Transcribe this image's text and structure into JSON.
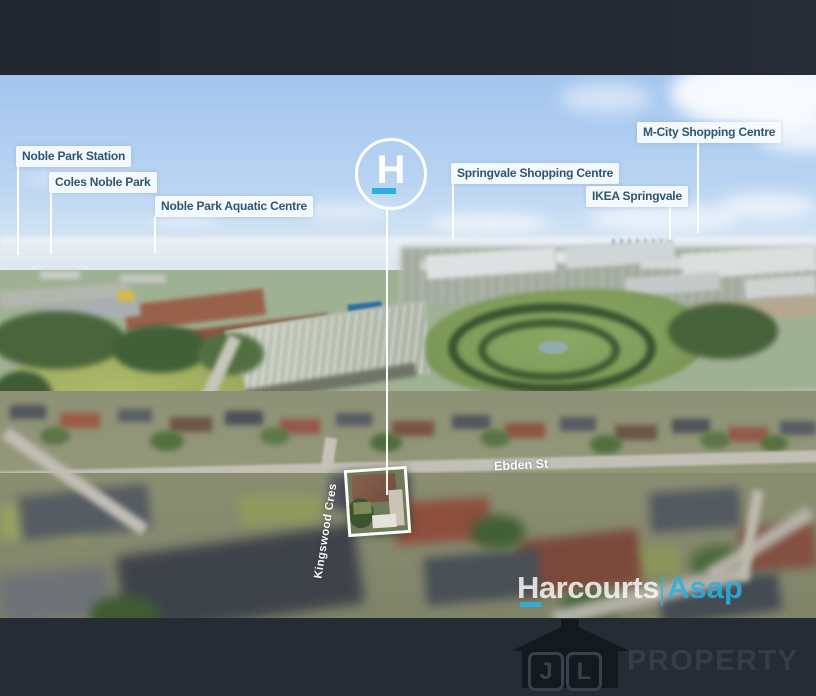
{
  "photo_overlay": {
    "location_labels": {
      "noble_park_station": "Noble Park Station",
      "coles_noble_park": "Coles Noble Park",
      "noble_park_aquatic_centre": "Noble Park Aquatic Centre",
      "springvale_shopping_centre": "Springvale Shopping Centre",
      "ikea_springvale": "IKEA Springvale",
      "m_city_shopping_centre": "M-City Shopping Centre"
    },
    "street_labels": {
      "ebden_st": "Ebden St",
      "kingswood_cres": "Kingswood Cres"
    },
    "property_marker": {
      "letter": "H"
    },
    "watermark": {
      "brand": "Harcourts",
      "agency": "Asap"
    }
  },
  "footer": {
    "logo_letters": {
      "first": "J",
      "second": "L"
    },
    "logo_text": "PROPERTY"
  },
  "colors": {
    "accent_cyan": "#29b1e6",
    "label_text": "#2e5670",
    "label_bg": "#f4f9fd",
    "top_bar": "#232831",
    "bottom_bar": "#262c35"
  }
}
